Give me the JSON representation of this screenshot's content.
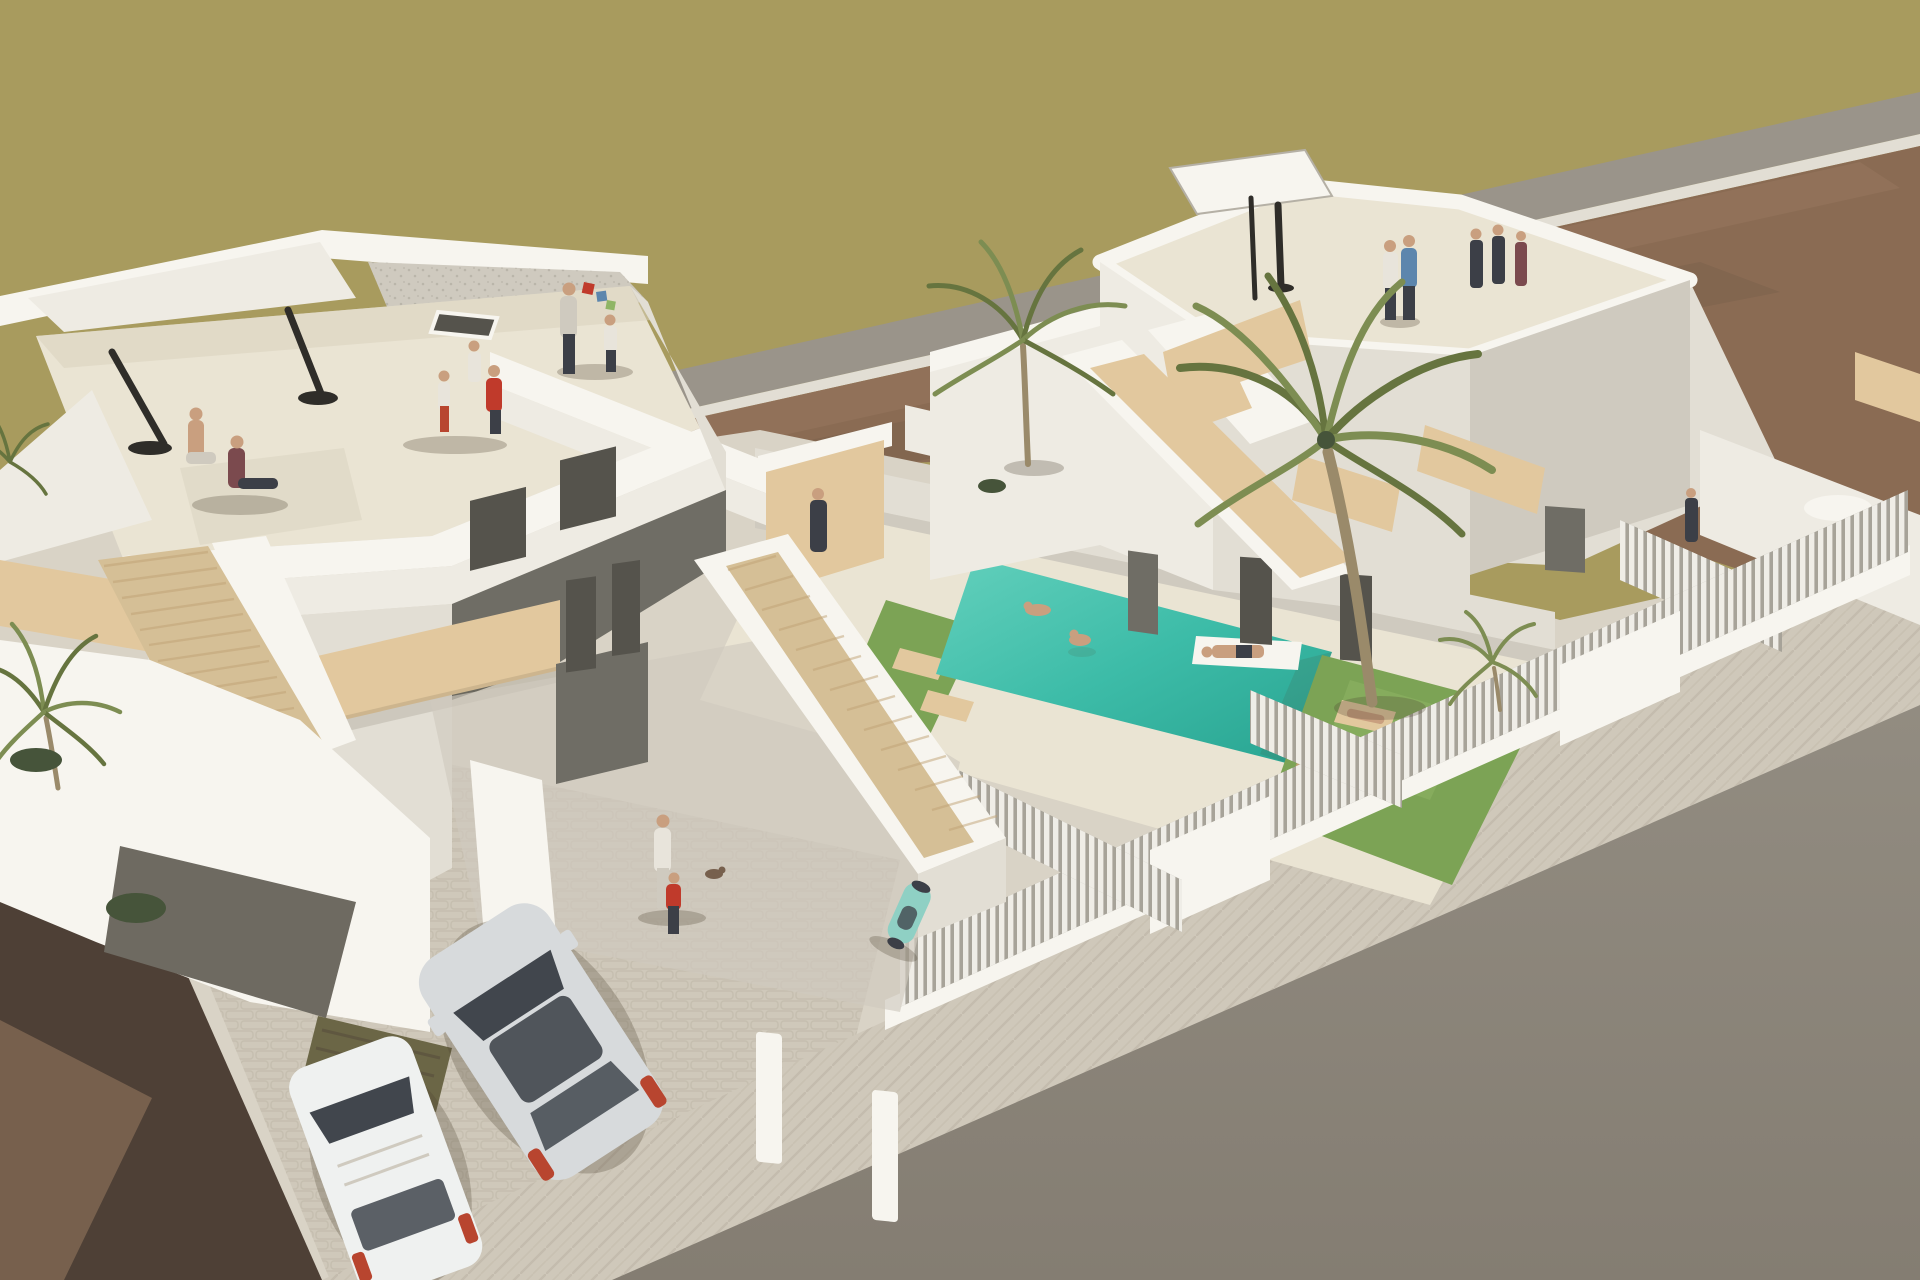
{
  "scene": {
    "kind": "architectural-3d-render",
    "view": "aerial-perspective",
    "description": "Aerial 3D visualization of two modern white villas with rooftop terraces and people, a turquoise swimming pool with swimmers and a float, lawns with sun loungers, palm trees, external beige staircases, slatted white fences, a parked silver hatchback and white van, olive field and dirt plots behind, grey road and pale sidewalk in front.",
    "objects": [
      "olive field",
      "grey rear road strip",
      "brown dirt plot",
      "left villa with roof terrace",
      "right villa with roof terrace",
      "swimming pool",
      "swimmers",
      "pool float",
      "sun loungers",
      "lawns",
      "palm trees",
      "external staircases",
      "wood balconies",
      "slatted fences",
      "silver hatchback",
      "white van",
      "teal scooter",
      "people",
      "closed parasols",
      "white parasol",
      "asphalt road",
      "paved sidewalk",
      "dark soil foreground",
      "carport canopy"
    ]
  },
  "colors": {
    "field_olive": "#a89b5e",
    "road_strip": "#9a948a",
    "dirt_brown": "#8a6b53",
    "dirt_brown_light": "#9d7f64",
    "dirt_dark": "#4e4036",
    "dirt_dark_light": "#77604d",
    "ground_pale": "#d9d3c6",
    "pave_light": "#cfc8ba",
    "pave_line": "#bcb3a3",
    "road_grey": "#928c81",
    "road_grey_dark": "#847d72",
    "white_sun": "#f7f5ef",
    "white_lit": "#eeebe3",
    "white_soft": "#e2ded4",
    "white_shade": "#cfcabf",
    "white_dark": "#b5b0a5",
    "terrace_floor": "#eae4d3",
    "terrace_shade": "#d8d1bd",
    "wood": "#e2c89e",
    "wood_dark": "#c0a173",
    "step": "#d5bf96",
    "glass_dark": "#55534c",
    "glass_mid": "#6f6d65",
    "pool_light": "#63d0bc",
    "pool_main": "#3dbca8",
    "pool_deep": "#28a390",
    "grass": "#7ca355",
    "grass_light": "#8fb565",
    "palm_dark": "#66743f",
    "palm_mid": "#7d8d52",
    "trunk": "#9a8a6a",
    "fence_white": "#efede7",
    "fence_gap": "#a7a399",
    "car_body": "#d7dadc",
    "car_glass": "#41464d",
    "car_red": "#b8452f",
    "van_white": "#eff1f0",
    "skin": "#c99f7f",
    "shirt_red": "#c03a2b",
    "shirt_maroon": "#7b4a4e",
    "shirt_blue": "#5d86ad",
    "shirt_white": "#e8e4db",
    "figure_dark": "#3c3f47",
    "parasol_dark": "#2f2d29",
    "scooter_teal": "#8fd0c4",
    "canopy_olive": "#6b6646",
    "shrub_green": "#46543a",
    "patio_grey": "#6e6a61",
    "shadow": "rgba(80,70,50,0.28)"
  }
}
